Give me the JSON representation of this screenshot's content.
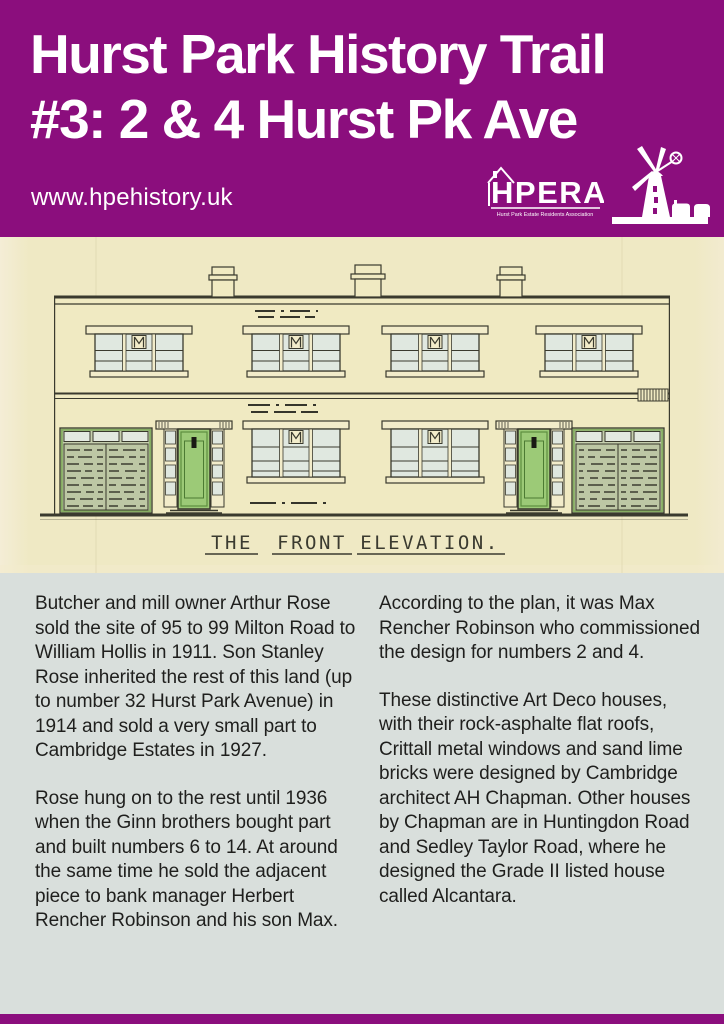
{
  "header": {
    "title_line1": "Hurst Park History Trail",
    "title_line2": "#3: 2 & 4 Hurst Pk Ave",
    "website_url": "www.hpehistory.uk",
    "background_color": "#8B0E7D",
    "text_color": "#FFFFFF",
    "hpera_logo": {
      "acronym": "HPERA",
      "subtitle": "Hurst Park Estate Residents Association"
    },
    "windmill_logo": "windmill-with-houses"
  },
  "drawing": {
    "caption": "THE FRONT ELEVATION.",
    "caption_words": [
      "THE",
      "FRONT",
      "ELEVATION."
    ],
    "paper_color": "#EFE9C4",
    "ink_color": "#3A3A2E",
    "door_color": "#9CCA77",
    "garage_color": "#BDC7A4",
    "window_pane_color": "#E0E8E0"
  },
  "article": {
    "background_color": "#D9DFDC",
    "text_color": "#1F1F1D",
    "left_column": {
      "paragraph1": "Butcher and mill owner Arthur Rose sold the site of 95 to 99 Milton Road to William Hollis in 1911. Son Stanley Rose inherited the rest of this land (up to number 32 Hurst Park Avenue) in 1914 and sold a very small part to Cambridge Estates in 1927.",
      "paragraph2": "Rose hung on to the rest until 1936 when the Ginn brothers bought part and built numbers 6 to 14. At around the same time he sold the adjacent piece to bank manager Herbert Rencher Robinson and his son Max."
    },
    "right_column": {
      "paragraph1": "According to the plan, it was Max Rencher Robinson who commissioned the design for numbers 2 and 4.",
      "paragraph2": "These distinctive Art Deco houses, with their rock-asphalte flat roofs, Crittall metal windows and sand lime bricks were designed by Cambridge architect AH Chapman. Other houses by Chapman are in Huntingdon Road and Sedley Taylor Road, where he designed the Grade II listed house called Alcantara."
    }
  },
  "footer": {
    "background_color": "#8B0E7D"
  }
}
